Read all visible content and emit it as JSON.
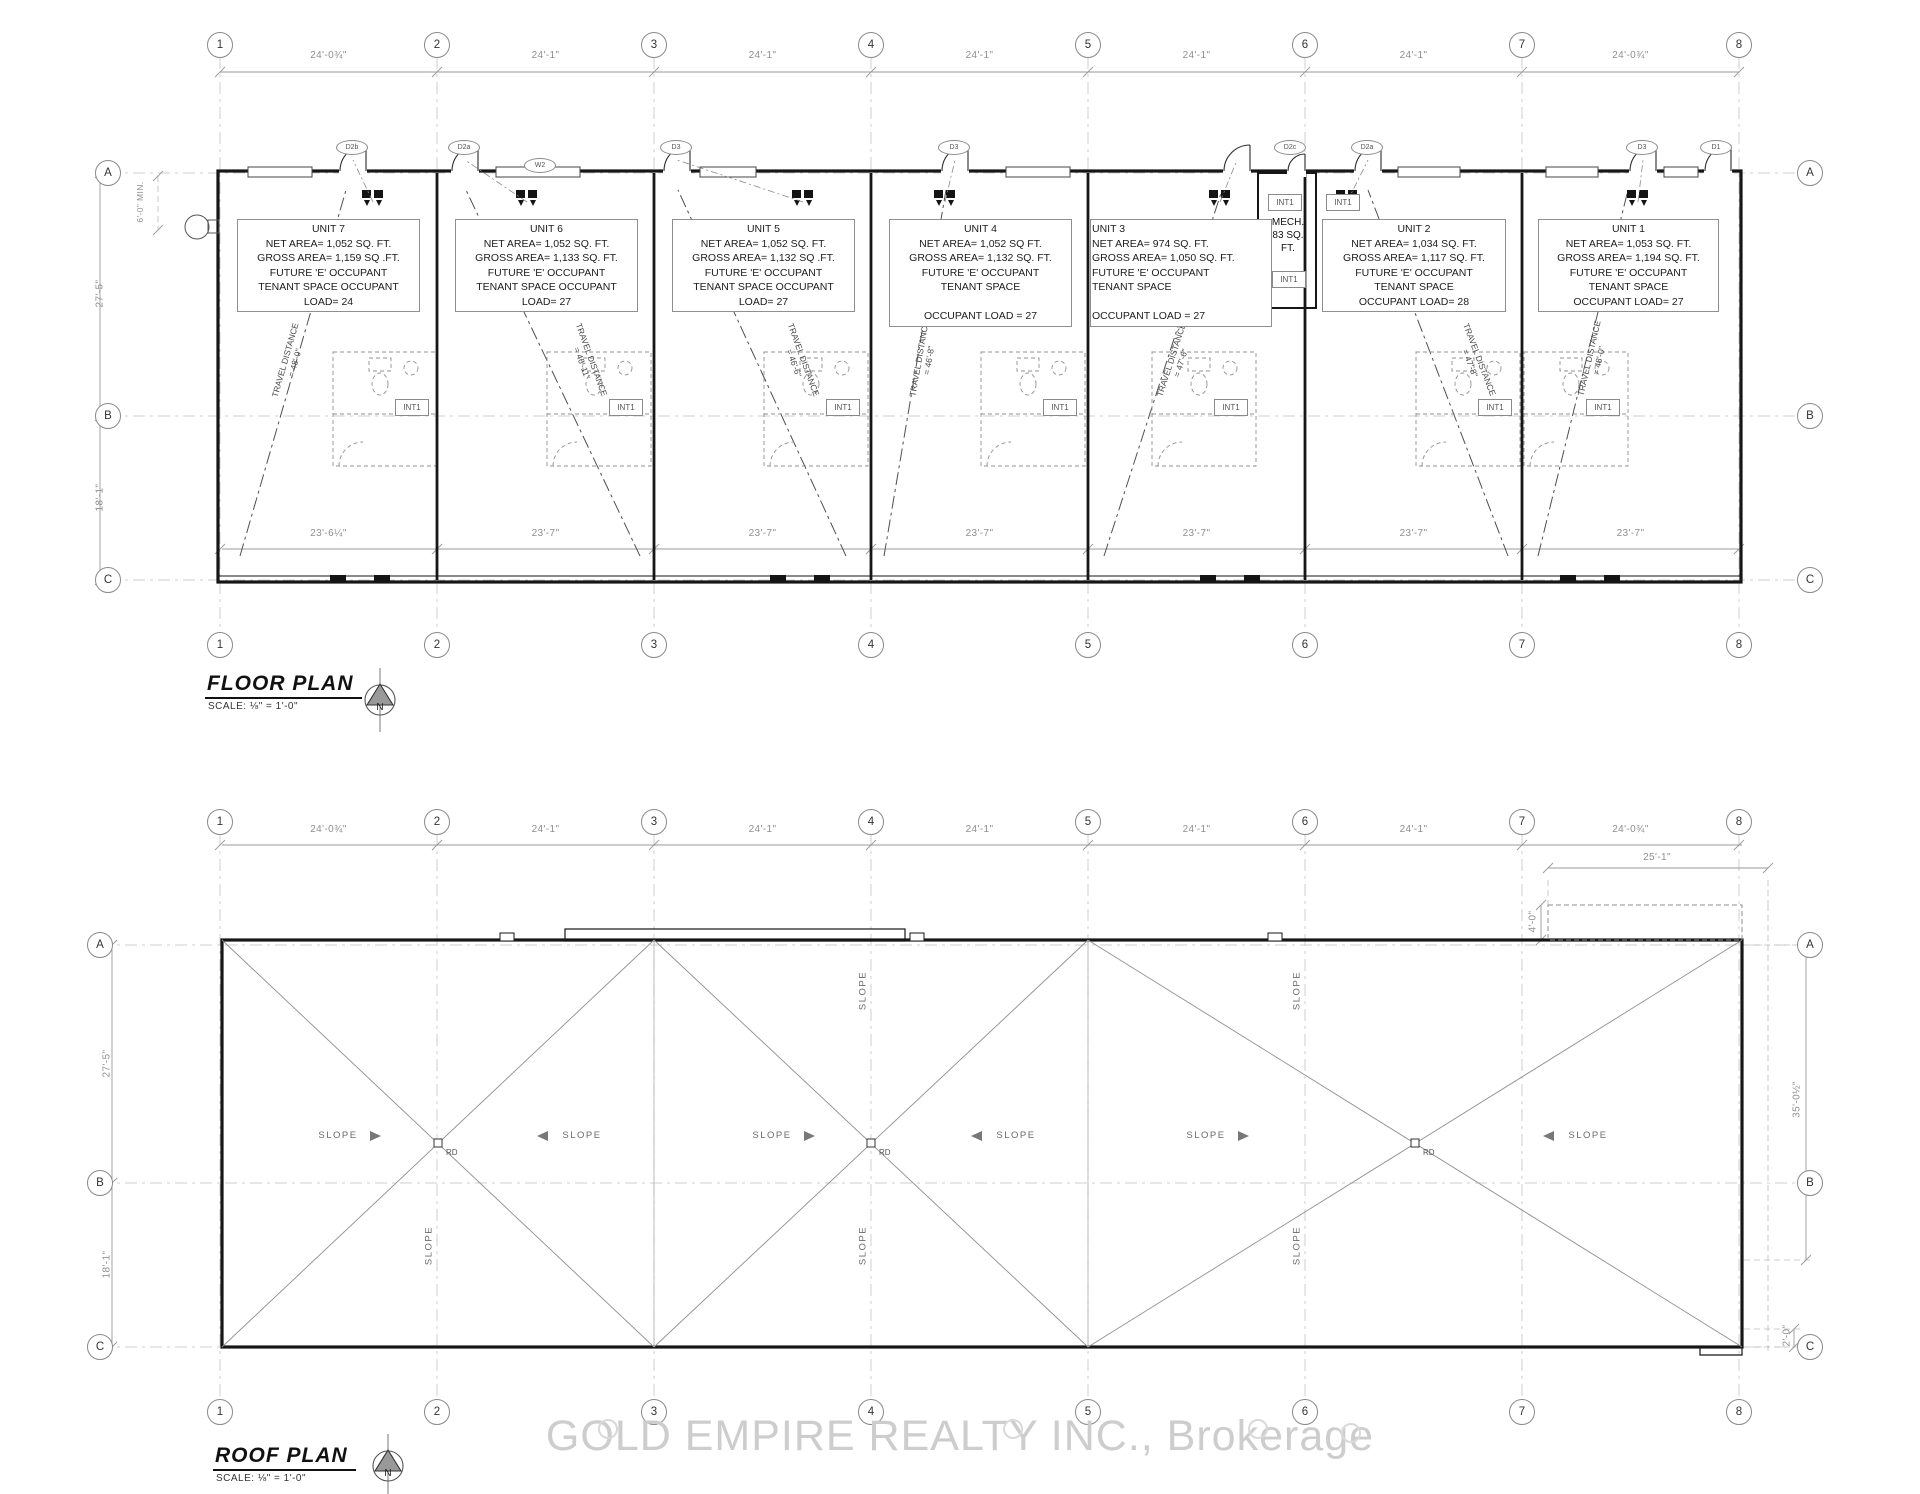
{
  "watermark": {
    "text": "GOLD EMPIRE REALTY INC., Brokerage"
  },
  "shared": {
    "int1_tag": "INT1",
    "north_letter": "N"
  },
  "floor_plan": {
    "title": "FLOOR PLAN",
    "scale_note": "SCALE: ⅛\" = 1'-0\"",
    "grid_cols": [
      "1",
      "2",
      "3",
      "4",
      "5",
      "6",
      "7",
      "8"
    ],
    "grid_rows": [
      "A",
      "B",
      "C"
    ],
    "top_dims": [
      "24'-0¾\"",
      "24'-1\"",
      "24'-1\"",
      "24'-1\"",
      "24'-1\"",
      "24'-1\"",
      "24'-0¾\""
    ],
    "bottom_dims": [
      "23'-6¼\"",
      "23'-7\"",
      "23'-7\"",
      "23'-7\"",
      "23'-7\"",
      "23'-7\"",
      "23'-7\""
    ],
    "left_dims": {
      "top": "27'-5\"",
      "bottom": "18'-1\"",
      "min_note": "6'-0\" MIN."
    },
    "units": [
      {
        "name": "UNIT 7",
        "lines": [
          "NET AREA= 1,052 SQ. FT.",
          "GROSS AREA= 1,159 SQ .FT.",
          "FUTURE 'E' OCCUPANT",
          "TENANT SPACE OCCUPANT",
          "LOAD= 24"
        ]
      },
      {
        "name": "UNIT 6",
        "lines": [
          "NET AREA= 1,052 SQ. FT.",
          "GROSS AREA= 1,133 SQ. FT.",
          "FUTURE 'E' OCCUPANT",
          "TENANT SPACE OCCUPANT",
          "LOAD= 27"
        ]
      },
      {
        "name": "UNIT 5",
        "lines": [
          "NET AREA= 1,052 SQ. FT.",
          "GROSS AREA= 1,132 SQ .FT.",
          "FUTURE 'E' OCCUPANT",
          "TENANT SPACE OCCUPANT",
          "LOAD= 27"
        ]
      },
      {
        "name": "UNIT 4",
        "lines": [
          "NET AREA= 1,052 SQ  FT.",
          "GROSS AREA= 1,132 SQ. FT.",
          "FUTURE 'E' OCCUPANT",
          "TENANT SPACE",
          "",
          "OCCUPANT LOAD = 27"
        ]
      },
      {
        "name": "UNIT 3",
        "lines": [
          "NET AREA= 974 SQ. FT.",
          "GROSS AREA= 1,050 SQ. FT.",
          "FUTURE 'E' OCCUPANT",
          "TENANT SPACE",
          "",
          "OCCUPANT LOAD = 27"
        ]
      },
      {
        "name": "UNIT 2",
        "lines": [
          "NET AREA= 1,034 SQ. FT.",
          "GROSS AREA= 1,117 SQ. FT.",
          "FUTURE 'E' OCCUPANT",
          "TENANT SPACE",
          "OCCUPANT LOAD= 28"
        ]
      },
      {
        "name": "UNIT 1",
        "lines": [
          "NET AREA= 1,053 SQ. FT.",
          "GROSS AREA= 1,194 SQ. FT.",
          "FUTURE 'E' OCCUPANT",
          "TENANT SPACE",
          "OCCUPANT LOAD= 27"
        ]
      }
    ],
    "mech_room": {
      "l1": "MECH.",
      "l2": "83 SQ.",
      "l3": "FT."
    },
    "door_tags": [
      "D2b",
      "D2a",
      "W2",
      "D3",
      "D3",
      "D2c",
      "D2a",
      "D3",
      "D1"
    ],
    "travel_labels": [
      {
        "l1": "TRAVEL DISTANCE",
        "l2": "= 48'-0\""
      },
      {
        "l1": "TRAVEL DISTANCE",
        "l2": "= 46'-11\""
      },
      {
        "l1": "TRAVEL DISTANCE",
        "l2": "= 46'-6\""
      },
      {
        "l1": "TRAVEL DISTANCE",
        "l2": "= 46'-8\""
      },
      {
        "l1": "TRAVEL DISTANCE",
        "l2": "= 47'-6\""
      },
      {
        "l1": "TRAVEL DISTANCE",
        "l2": "= 47'-8\""
      },
      {
        "l1": "TRAVEL DISTANCE",
        "l2": "= 48'-0\""
      }
    ]
  },
  "roof_plan": {
    "title": "ROOF PLAN",
    "scale_note": "SCALE: ⅛\" = 1'-0\"",
    "grid_cols": [
      "1",
      "2",
      "3",
      "4",
      "5",
      "6",
      "7",
      "8"
    ],
    "grid_rows": [
      "A",
      "B",
      "C"
    ],
    "top_dims": [
      "24'-0¾\"",
      "24'-1\"",
      "24'-1\"",
      "24'-1\"",
      "24'-1\"",
      "24'-1\"",
      "24'-0¾\""
    ],
    "left_dims": {
      "top": "27'-5\"",
      "bottom": "18'-1\""
    },
    "aux_dims": {
      "offset": "25'-1\"",
      "parapet": "4'-0\"",
      "depth": "35'-0½\"",
      "corner": "2'-0\""
    },
    "slope_label": "SLOPE",
    "rd_label": "RD"
  }
}
